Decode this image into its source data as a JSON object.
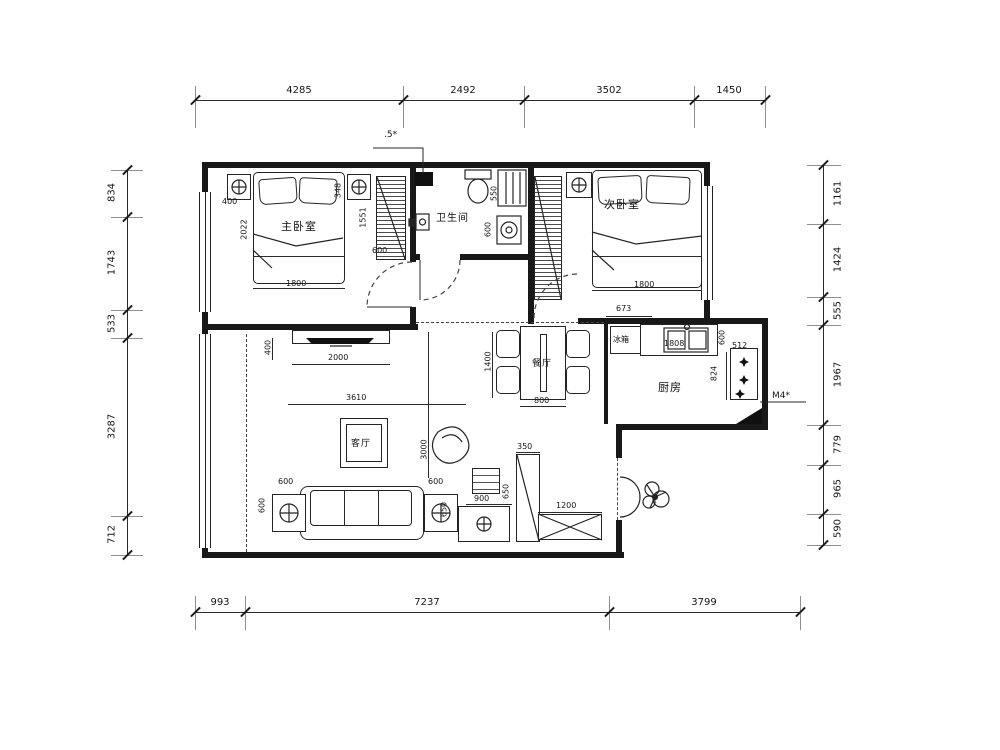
{
  "dims": {
    "top": [
      "4285",
      "2492",
      "3502",
      "1450"
    ],
    "bottom": [
      "993",
      "7237",
      "3799"
    ],
    "left": [
      "834",
      "1743",
      "533",
      "3287",
      "712"
    ],
    "right": [
      "1161",
      "1424",
      "555",
      "1967",
      "779",
      "965",
      "590"
    ],
    "inner": {
      "b1_400": "400",
      "b1_348": "348",
      "b1_2022": "2022",
      "b1_1800": "1800",
      "b1_1551": "1551",
      "b1_600": "600",
      "ba_550": "550",
      "ba_600": "600",
      "b2_1800": "1800",
      "b2_673": "673",
      "dn_1400": "1400",
      "dn_800": "800",
      "k_1808": "1808",
      "k_600": "600",
      "k_512": "512",
      "k_824": "824",
      "lv_400": "400",
      "lv_2000": "2000",
      "lv_3610": "3610",
      "lv_3000": "3000",
      "lv_600a": "600",
      "lv_600av": "600",
      "lv_600b": "600",
      "lv_650b": "650",
      "lv_900": "900",
      "lv_650c": "650",
      "lv_350": "350",
      "lv_1200": "1200"
    }
  },
  "rooms": {
    "bedroom1": "主卧室",
    "bedroom2": "次卧室",
    "bathroom": "卫生间",
    "kitchen": "厨房",
    "living": "客厅",
    "dining": "餐厅",
    "fridge": "冰箱"
  },
  "annotations": {
    "top_tag": ".5*",
    "right_tag": "M4*"
  },
  "colors": {
    "line": "#181818",
    "dash": "#444444"
  }
}
